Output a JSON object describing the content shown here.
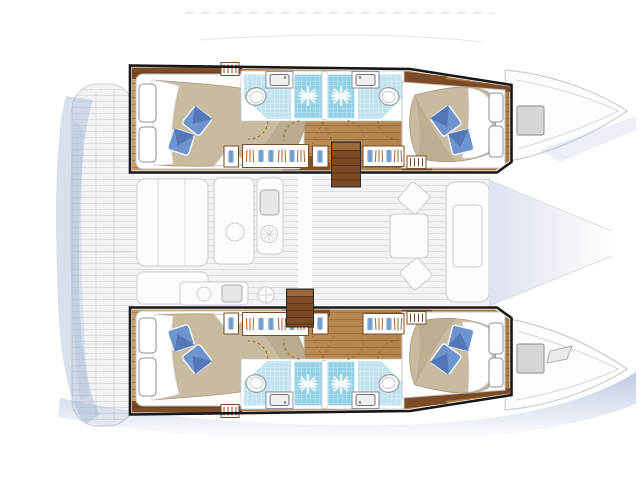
{
  "diagram": {
    "type": "yacht-floor-plan",
    "vessel_type": "catamaran",
    "view": "top-down layout plan",
    "orientation": "bow-right",
    "highlighted_areas": [
      "upper-hull-accommodation",
      "lower-hull-accommodation"
    ],
    "ghosted_areas": [
      "stern-platform",
      "aft-cockpit",
      "saloon",
      "galley",
      "dinette",
      "foredeck",
      "bow-peaks"
    ],
    "components": {
      "hulls": 2,
      "cabins_per_hull": 2,
      "double_beds": 4,
      "pillows_per_bed": 2,
      "bathrooms_per_hull": 2,
      "shower_stalls_per_hull": 2,
      "toilets_per_hull": 2,
      "sinks_per_hull": 2,
      "wardrobes_per_hull": 2,
      "companionway_stairs": 2,
      "bow_deck_hatches": 2
    }
  },
  "colors": {
    "outline": "#161616",
    "wood-light": "#c9a06b",
    "wood-mid": "#b4854f",
    "wood-dark": "#7c4a24",
    "wood-deep": "#57341a",
    "plank-line": "#8f6132",
    "mattress": "#c9bb9f",
    "mattress-shade": "#b2a286",
    "sheet": "#ffffff",
    "pillow": "#6e94cf",
    "pillow-dark": "#4d72b2",
    "tile": "#bfe2ee",
    "tile-deep": "#8fd0e4",
    "tile-grid": "#7fc0d8",
    "fixture": "#8f969e",
    "door-swing": "#a2712f",
    "ghost-line": "#c9cdd3",
    "ghost-fill": "#f2f3f5",
    "ghost-white": "#fbfcfd",
    "water": "#a9b8d8",
    "hatch": "#d5d6d8",
    "hatch-stroke": "#9aa0a6",
    "garment-blue": "#7fa9d9",
    "hanger-stroke": "#a2642f"
  }
}
